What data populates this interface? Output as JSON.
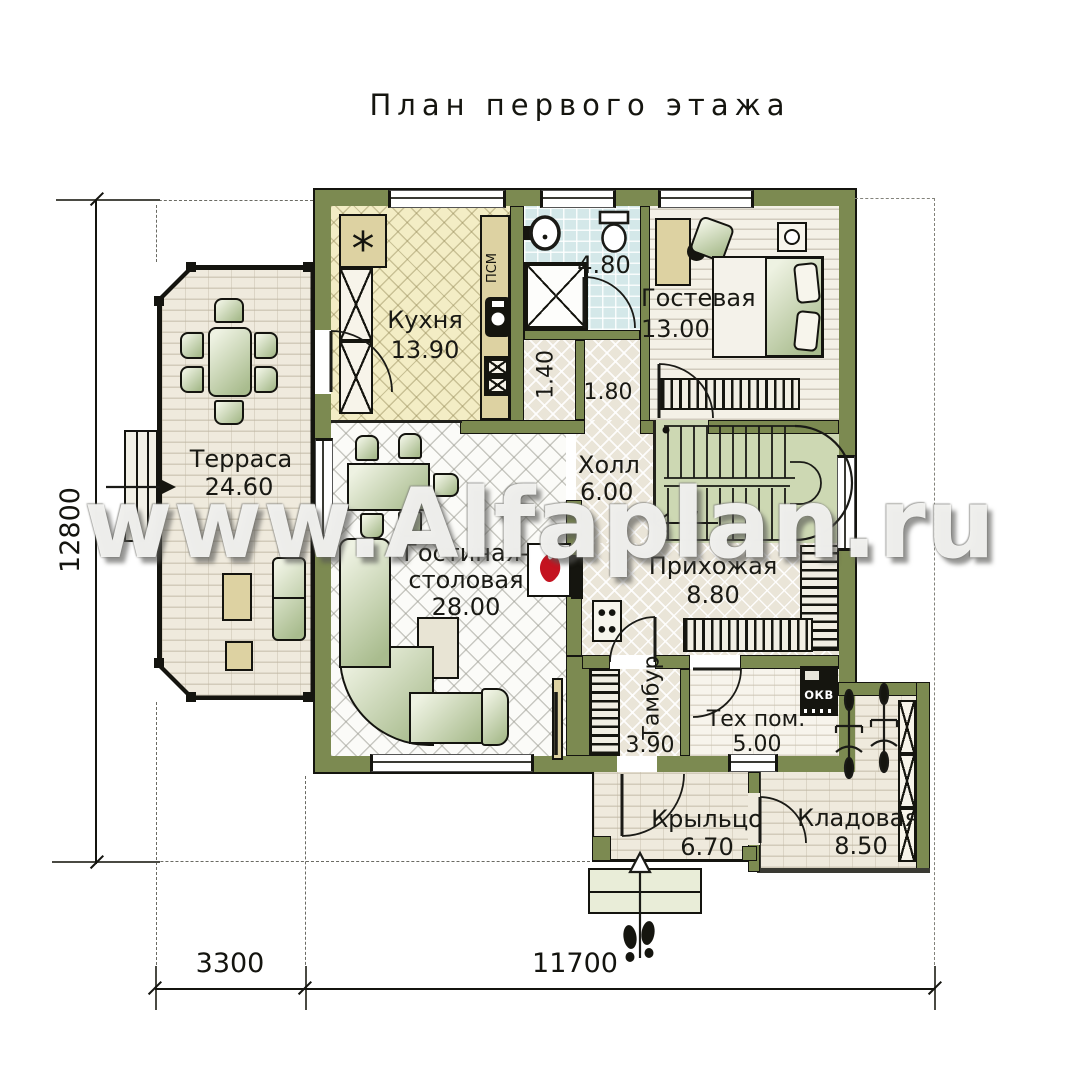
{
  "title": "План первого этажа",
  "watermark": "www.Alfaplan.ru",
  "rooms": {
    "kitchen": {
      "name": "Кухня",
      "area": "13.90"
    },
    "bathroom": {
      "area": "4.80"
    },
    "corridor_small": {
      "area": "1.40"
    },
    "corridor": {
      "area": "1.80"
    },
    "guest": {
      "name": "Гостевая",
      "area": "13.00"
    },
    "hall": {
      "name": "Холл",
      "area": "6.00"
    },
    "terrace": {
      "name": "Терраса",
      "area": "24.60"
    },
    "living": {
      "name_line1": "Гостиная-",
      "name_line2": "столовая",
      "area": "28.00"
    },
    "entry": {
      "name": "Прихожая",
      "area": "8.80"
    },
    "tambour": {
      "name": "Тамбур",
      "area": "3.90"
    },
    "tech": {
      "name": "Тех пом.",
      "area": "5.00"
    },
    "porch": {
      "name": "Крыльцо",
      "area": "6.70"
    },
    "storage": {
      "name": "Кладовая",
      "area": "8.50"
    }
  },
  "equipment": {
    "washing_machine": "ПСМ",
    "boiler": "ОКВ",
    "fridge_symbol": "*"
  },
  "dimensions": {
    "total_height": "12800",
    "bottom_left_width": "3300",
    "bottom_right_width": "11700"
  },
  "colors": {
    "wall": "#7c8a51",
    "kitchen_floor": "#f3edc5",
    "bath_floor": "#d4e8e9",
    "stairs_floor": "#cdd8b3",
    "beige_floor": "#eae5d8",
    "fireplace_accent": "#c41320"
  }
}
